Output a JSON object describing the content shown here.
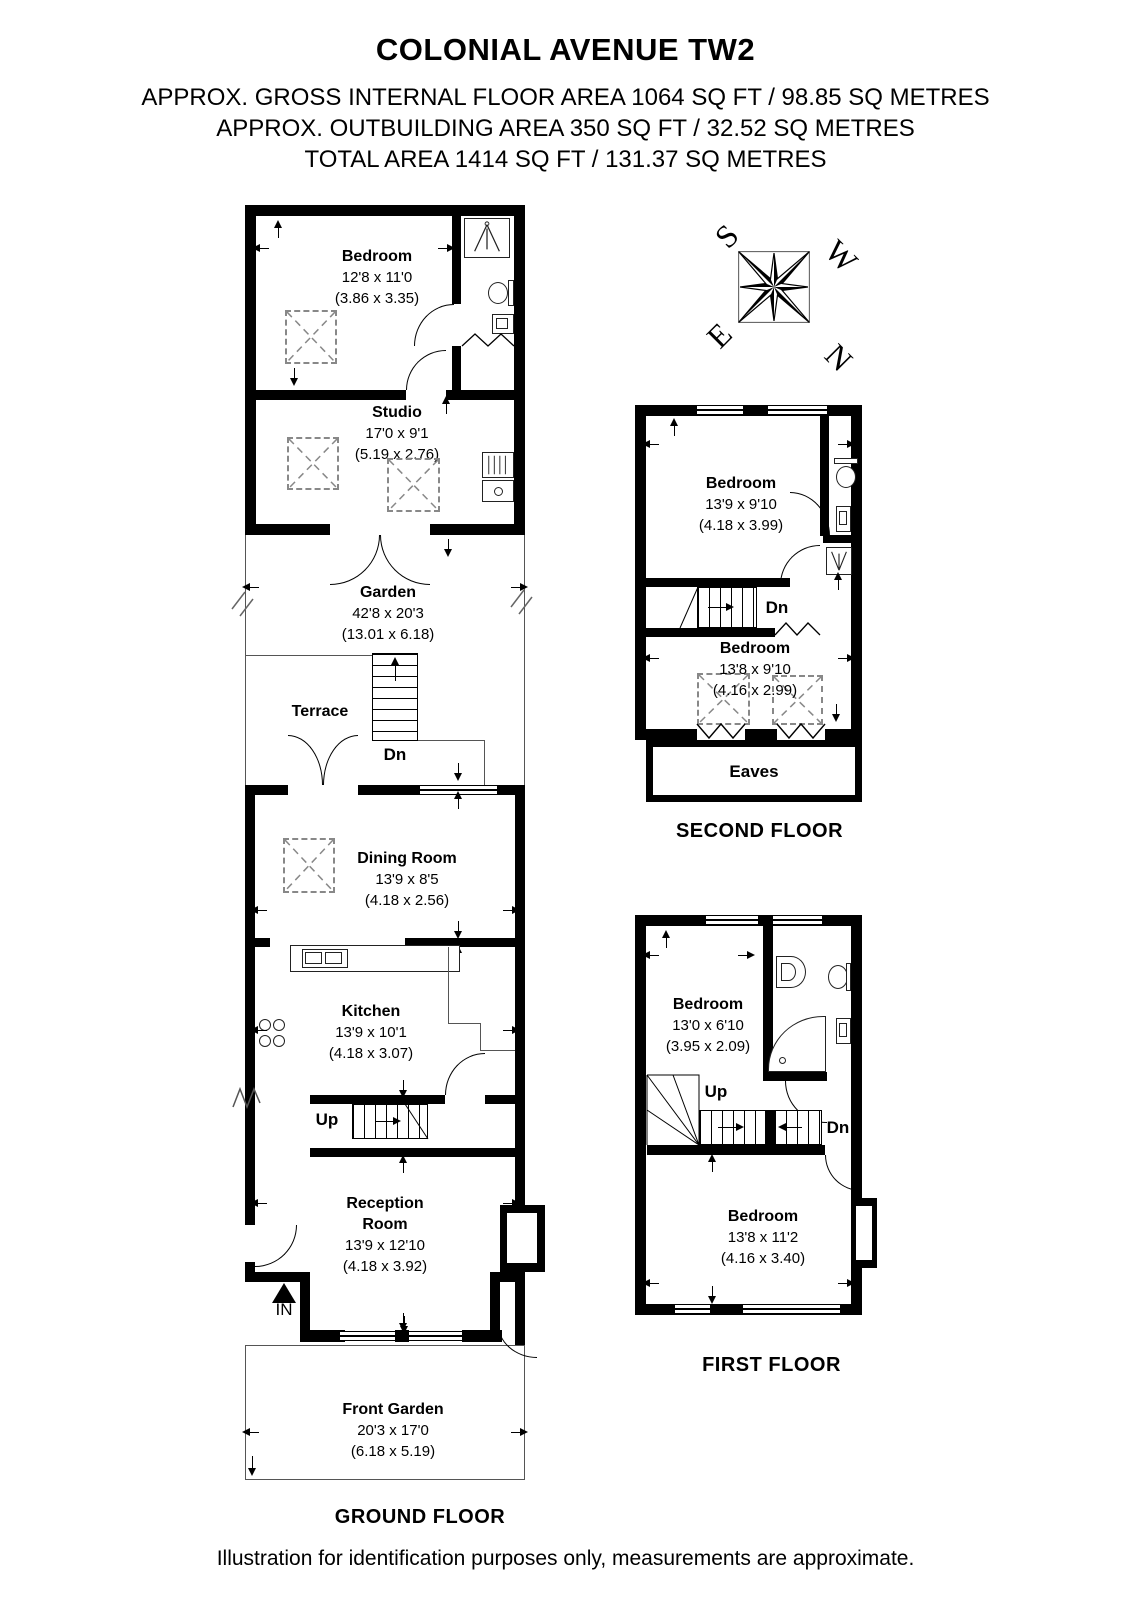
{
  "header": {
    "title": "COLONIAL AVENUE TW2",
    "line1": "APPROX. GROSS INTERNAL FLOOR AREA 1064 SQ FT / 98.85 SQ METRES",
    "line2": "APPROX. OUTBUILDING AREA 350 SQ FT / 32.52 SQ METRES",
    "line3": "TOTAL AREA 1414 SQ FT / 131.37 SQ METRES"
  },
  "compass": {
    "north": "N",
    "south": "S",
    "east": "E",
    "west": "W"
  },
  "outbuilding": {
    "bedroom": {
      "name": "Bedroom",
      "dims_ft": "12'8 x 11'0",
      "dims_m": "(3.86 x 3.35)"
    },
    "studio": {
      "name": "Studio",
      "dims_ft": "17'0 x 9'1",
      "dims_m": "(5.19 x 2.76)"
    }
  },
  "ground_floor": {
    "label": "GROUND FLOOR",
    "garden": {
      "name": "Garden",
      "dims_ft": "42'8 x 20'3",
      "dims_m": "(13.01 x 6.18)"
    },
    "terrace": {
      "name": "Terrace",
      "dn": "Dn"
    },
    "dining_room": {
      "name": "Dining Room",
      "dims_ft": "13'9 x 8'5",
      "dims_m": "(4.18 x 2.56)"
    },
    "kitchen": {
      "name": "Kitchen",
      "dims_ft": "13'9 x 10'1",
      "dims_m": "(4.18 x 3.07)"
    },
    "stairs": {
      "up": "Up"
    },
    "reception_room": {
      "name": "Reception Room",
      "dims_ft": "13'9 x 12'10",
      "dims_m": "(4.18 x 3.92)"
    },
    "entrance_label": "IN",
    "front_garden": {
      "name": "Front Garden",
      "dims_ft": "20'3 x 17'0",
      "dims_m": "(6.18 x 5.19)"
    }
  },
  "second_floor": {
    "label": "SECOND FLOOR",
    "bedroom_front": {
      "name": "Bedroom",
      "dims_ft": "13'9 x 9'10",
      "dims_m": "(4.18 x 3.99)"
    },
    "bedroom_rear": {
      "name": "Bedroom",
      "dims_ft": "13'8 x 9'10",
      "dims_m": "(4.16 x 2.99)"
    },
    "stairs": {
      "dn": "Dn"
    },
    "eaves_label": "Eaves"
  },
  "first_floor": {
    "label": "FIRST FLOOR",
    "bedroom_front": {
      "name": "Bedroom",
      "dims_ft": "13'0 x 6'10",
      "dims_m": "(3.95 x 2.09)"
    },
    "bedroom_rear": {
      "name": "Bedroom",
      "dims_ft": "13'8 x 11'2",
      "dims_m": "(4.16 x 3.40)"
    },
    "stairs": {
      "up": "Up",
      "dn": "Dn"
    }
  },
  "footer": {
    "note": "Illustration for identification purposes only, measurements are approximate."
  }
}
